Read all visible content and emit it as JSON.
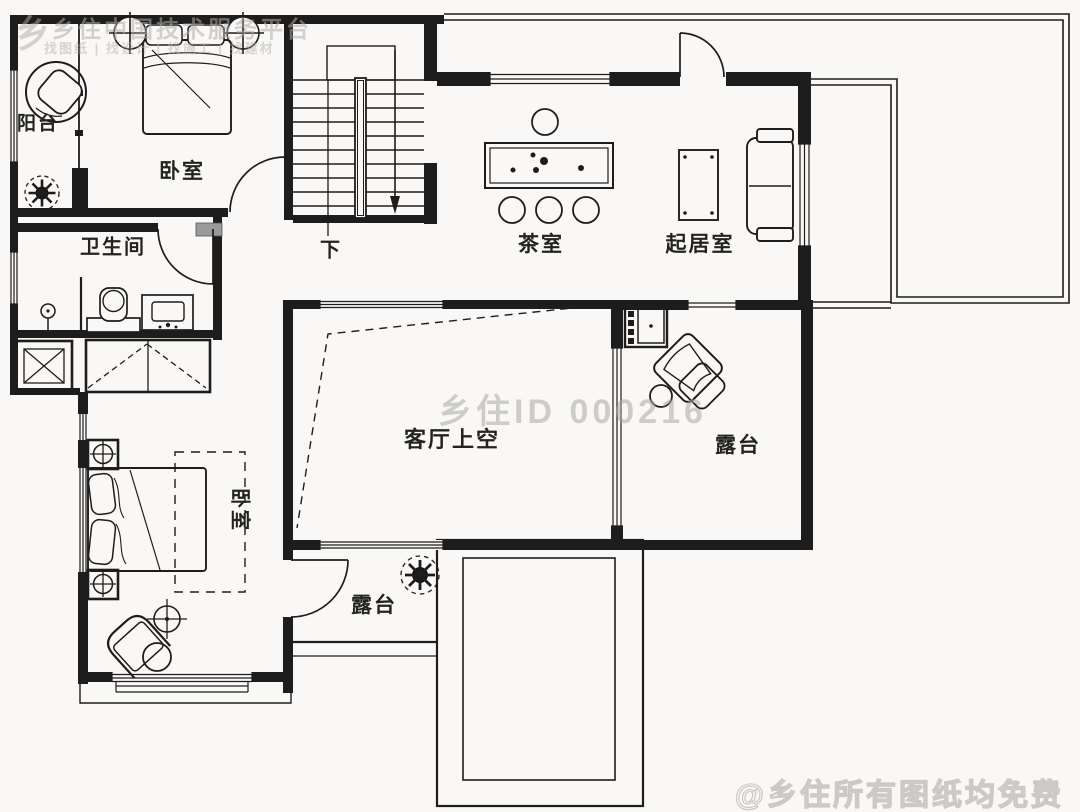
{
  "watermarks": {
    "brand_logo_glyph": "乡",
    "brand_line1": "乡住中国技术服务平台",
    "brand_line2": "找图纸 | 找设计 | 找施工 | 找建材",
    "center_id": "乡住ID 000216",
    "credit": "@乡住所有图纸均免费"
  },
  "rooms": {
    "balcony": "阳台",
    "bedroom_top": "卧室",
    "stairs_down": "下",
    "bathroom": "卫生间",
    "tea_room": "茶室",
    "living_room": "起居室",
    "void_over_living": "客厅上空",
    "terrace_right": "露台",
    "bedroom_bottom": "卧室",
    "terrace_bottom": "露台"
  },
  "colors": {
    "line": "#1d1d1d",
    "background": "#f9f8f7",
    "watermark_gray": "#c7c3bf",
    "duct_fill": "#9a9a9a"
  }
}
